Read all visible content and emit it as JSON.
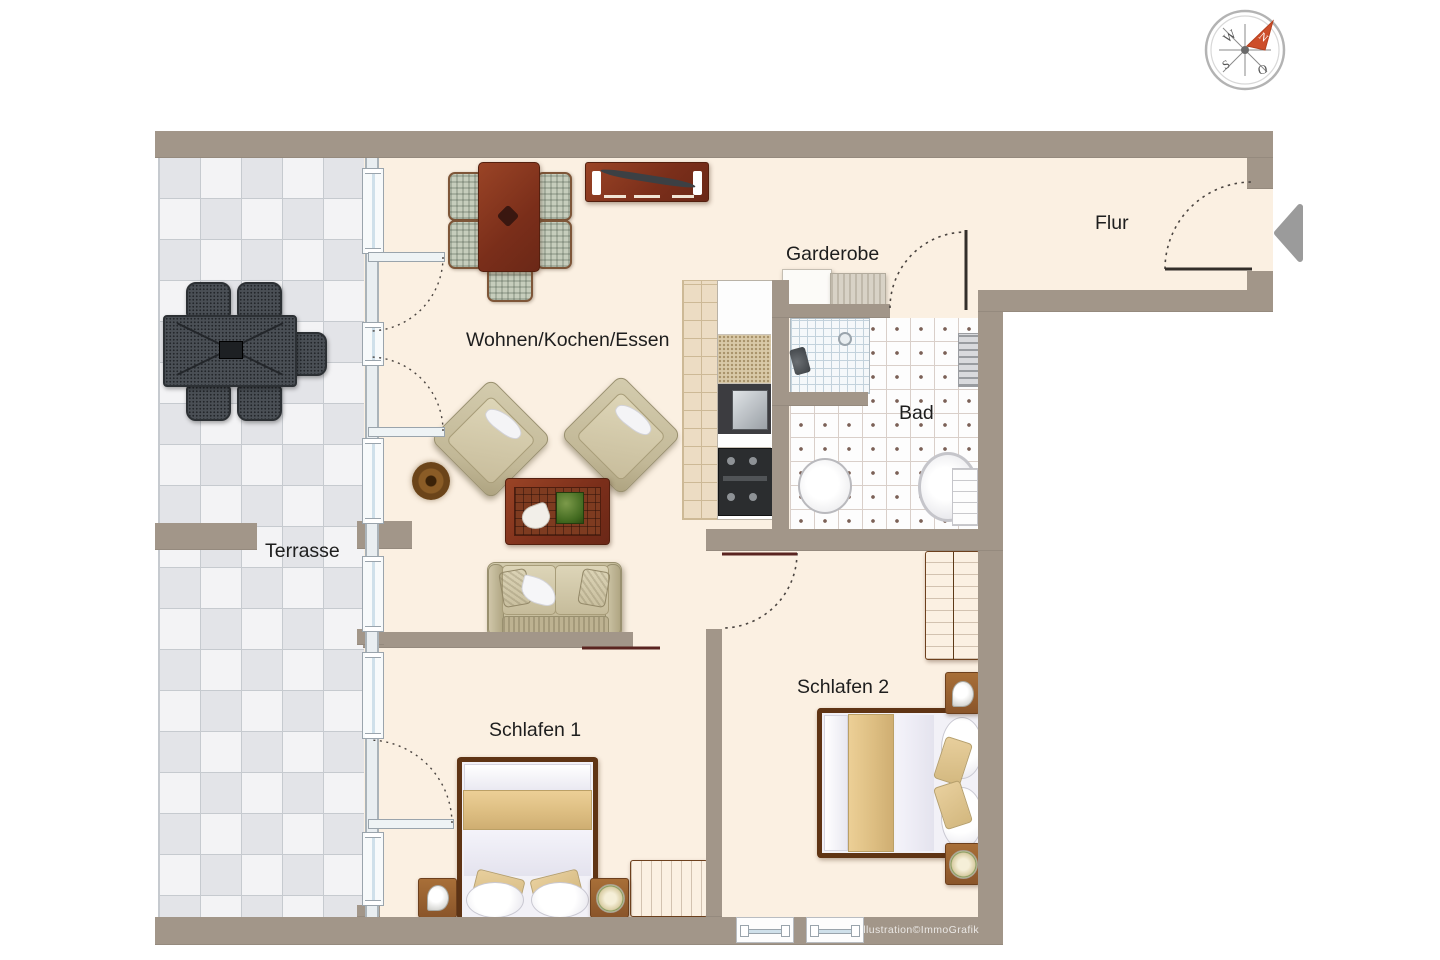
{
  "rooms": {
    "flur": {
      "label": "Flur"
    },
    "garderobe": {
      "label": "Garderobe"
    },
    "bad": {
      "label": "Bad"
    },
    "wohnen": {
      "label": "Wohnen/Kochen/Essen"
    },
    "terrasse": {
      "label": "Terrasse"
    },
    "schlafen1": {
      "label": "Schlafen 1"
    },
    "schlafen2": {
      "label": "Schlafen 2"
    }
  },
  "compass": {
    "n": "N",
    "o": "O",
    "s": "S",
    "w": "W"
  },
  "watermark": "Illustration©ImmoGrafik",
  "colors": {
    "wall": "#a29689",
    "floor": "#fbf0e2",
    "terrace_light": "#f3f3f5",
    "terrace_dark": "#e3e4e8",
    "wood_dark": "#7a2e1a",
    "wood_mid": "#8a552a",
    "upholstery_beige": "#c2b897",
    "blanket_tan": "#ddbe82",
    "outdoor_gray": "#4a4f55",
    "compass_arrow": "#cd4e2a",
    "entry_arrow": "#9b9b9b"
  }
}
